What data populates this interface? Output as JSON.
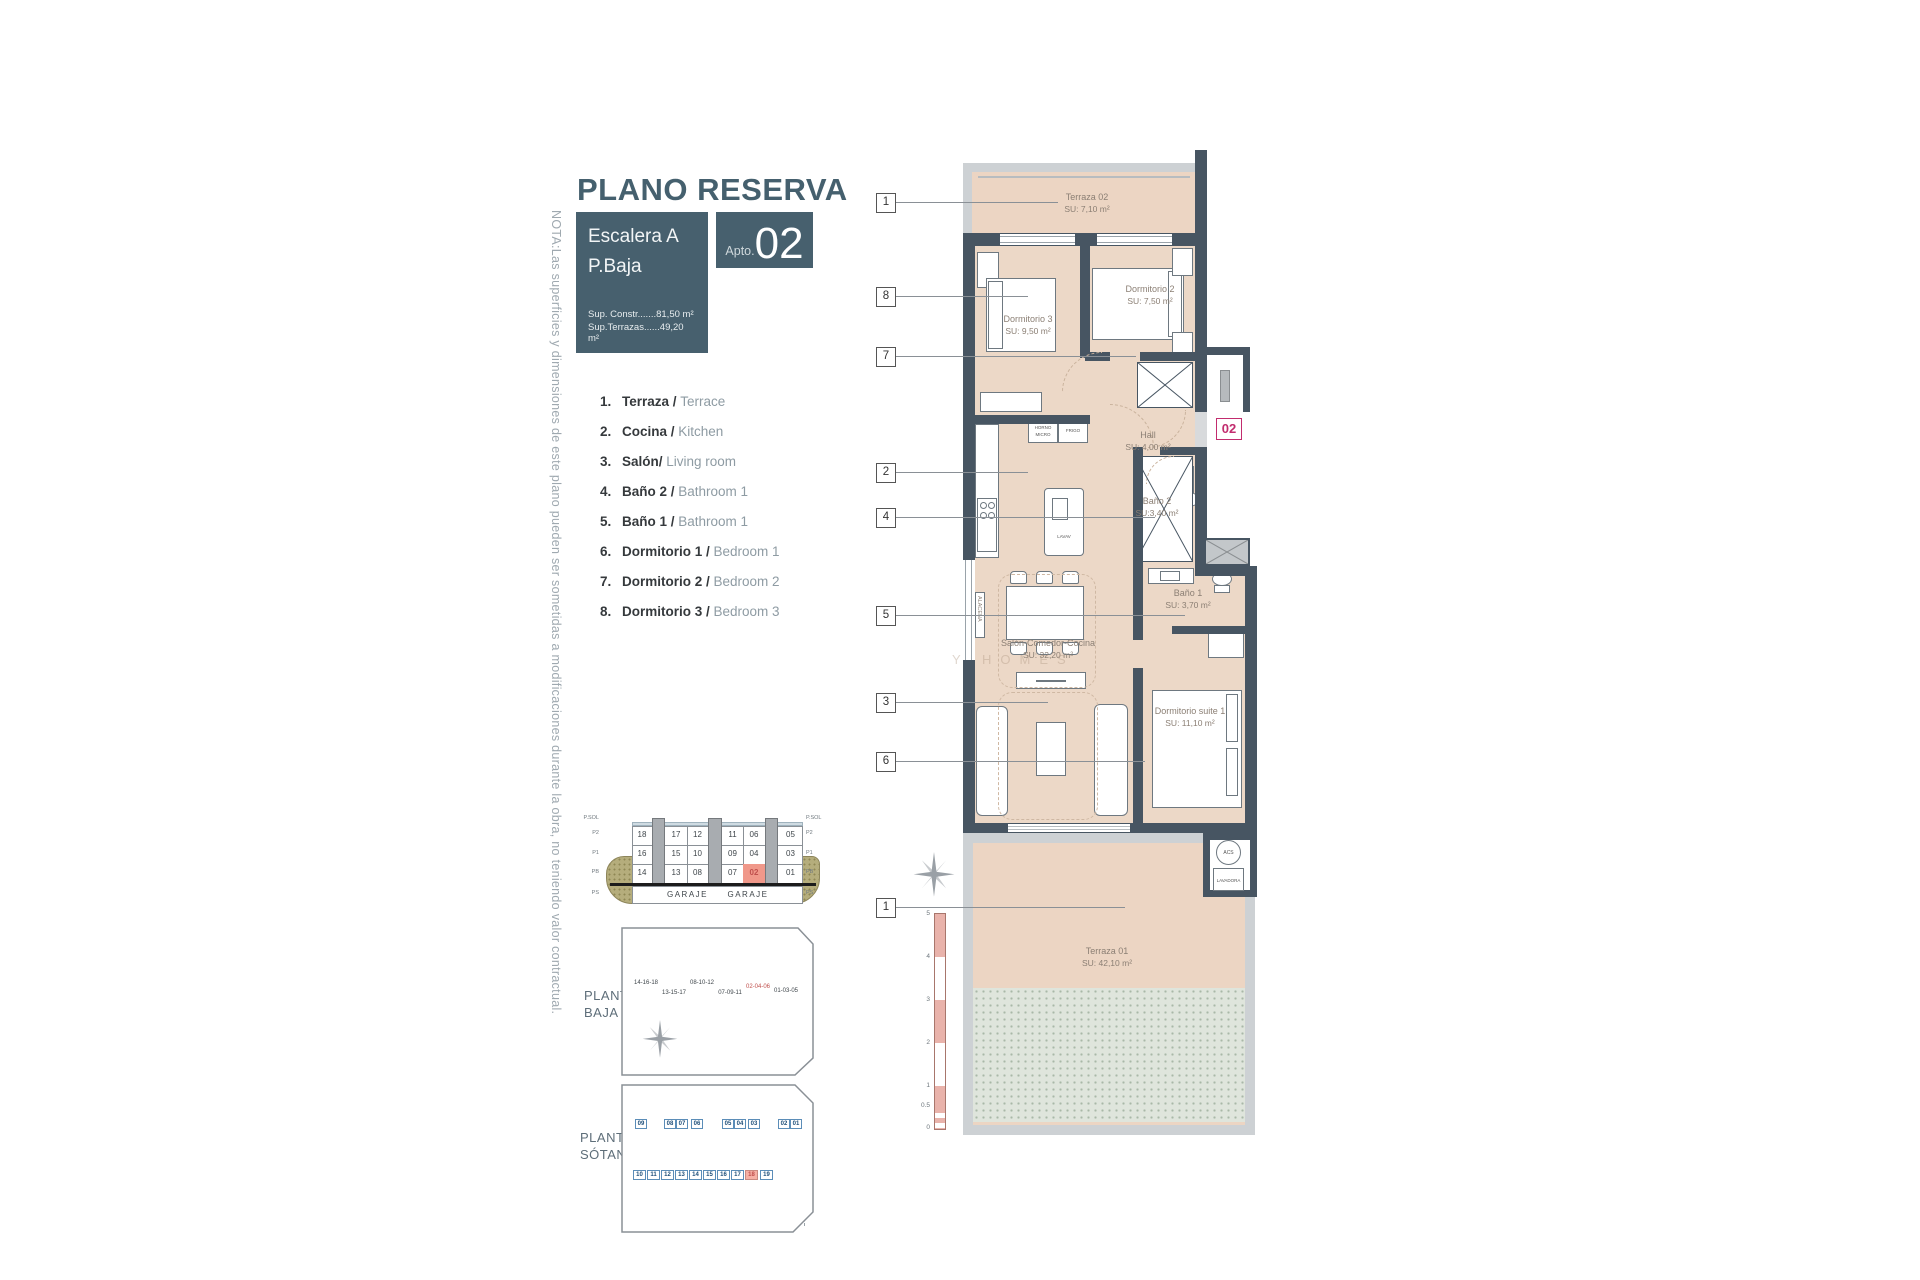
{
  "note": "NOTA:Las superficies y dimensiones de este plano pueden ser sometidas a modificaciones durante la obra, no teniendo valor contractual.",
  "header": {
    "title": "PLANO RESERVA",
    "block_line1": "Escalera A",
    "block_line2": "P.Baja",
    "sup_constr": "Sup. Constr.......81,50 m²",
    "sup_terrazas": "Sup.Terrazas......49,20 m²",
    "apto_label": "Apto.",
    "apto_number": "02"
  },
  "legend": [
    {
      "num": "1.",
      "es": "Terraza / ",
      "en": "Terrace"
    },
    {
      "num": "2.",
      "es": "Cocina / ",
      "en": "Kitchen"
    },
    {
      "num": "3.",
      "es": "Salón/ ",
      "en": "Living room"
    },
    {
      "num": "4.",
      "es": "Baño 2 / ",
      "en": "Bathroom 1"
    },
    {
      "num": "5.",
      "es": "Baño 1 / ",
      "en": "Bathroom 1"
    },
    {
      "num": "6.",
      "es": "Dormitorio 1 / ",
      "en": "Bedroom 1"
    },
    {
      "num": "7.",
      "es": "Dormitorio 2 / ",
      "en": "Bedroom 2"
    },
    {
      "num": "8.",
      "es": "Dormitorio 3 / ",
      "en": "Bedroom 3"
    }
  ],
  "plan": {
    "unit_badge": "02",
    "watermark": "Y HOMES",
    "rooms": {
      "terraza02": {
        "name": "Terraza 02",
        "su": "SU: 7,10 m²"
      },
      "dormitorio3": {
        "name": "Dormitorio 3",
        "su": "SU: 9,50 m²"
      },
      "dormitorio2": {
        "name": "Dormitorio 2",
        "su": "SU: 7,50 m²"
      },
      "hall": {
        "name": "Hall",
        "su": "SU: 4,00 m²"
      },
      "bano2": {
        "name": "Baño 2",
        "su": "SU:3,40 m²"
      },
      "bano1": {
        "name": "Baño 1",
        "su": "SU: 3,70 m²"
      },
      "salon": {
        "name": "Salón-Comedor-Cocina",
        "su": "SU: 32,20 m²"
      },
      "suite": {
        "name": "Dormitorio suite 1",
        "su": "SU: 11,10 m²"
      },
      "terraza01": {
        "name": "Terraza 01",
        "su": "SU: 42,10 m²"
      }
    },
    "fixtures": {
      "horno_l1": "HORNO",
      "horno_l2": "MICRO",
      "frigo": "FRIGO",
      "lavav": "LAVAV",
      "alacena": "ALACENA",
      "acs": "ACS",
      "lavadora": "LAVADORA"
    },
    "callouts": [
      {
        "num": "1"
      },
      {
        "num": "8"
      },
      {
        "num": "7"
      },
      {
        "num": "2"
      },
      {
        "num": "4"
      },
      {
        "num": "5"
      },
      {
        "num": "3"
      },
      {
        "num": "6"
      },
      {
        "num": "1"
      }
    ],
    "scale_labels": [
      "5",
      "4",
      "3",
      "2",
      "1",
      "0.5",
      "0"
    ]
  },
  "section": {
    "levels_left": [
      "P.SOL",
      "P2",
      "P1",
      "PB",
      "PS"
    ],
    "levels_right": [
      "P.SOL",
      "P2",
      "P1",
      "PB",
      "PS"
    ],
    "rows": [
      [
        "18",
        "17",
        "12",
        "11",
        "06",
        "05"
      ],
      [
        "16",
        "15",
        "10",
        "09",
        "04",
        "03"
      ],
      [
        "14",
        "13",
        "08",
        "07",
        "02",
        "01"
      ]
    ],
    "garaje": [
      "GARAJE",
      "GARAJE"
    ],
    "highlight": "02"
  },
  "baja": {
    "label1": "PLANTA",
    "label2": "BAJA",
    "units": [
      "14-16-18",
      "13-15-17",
      "08-10-12",
      "07-09-11",
      "02-04-06",
      "01-03-05"
    ],
    "highlight": "02-04-06"
  },
  "sotano": {
    "label1": "PLANTA",
    "label2": "SÓTANO",
    "storage": [
      "09",
      "08",
      "07",
      "06",
      "05",
      "04",
      "03",
      "02",
      "01"
    ],
    "parking": [
      "10",
      "11",
      "12",
      "13",
      "14",
      "15",
      "16",
      "17",
      "18",
      "19"
    ],
    "highlight": "18"
  },
  "colors": {
    "teal": "#47606e",
    "wall": "#475562",
    "floor": "#ecd8c7",
    "terrace_frame": "#cdd1d4",
    "magenta": "#c22c6e",
    "highlight_pink": "#f0988a",
    "olive": "#b5ad7c"
  }
}
